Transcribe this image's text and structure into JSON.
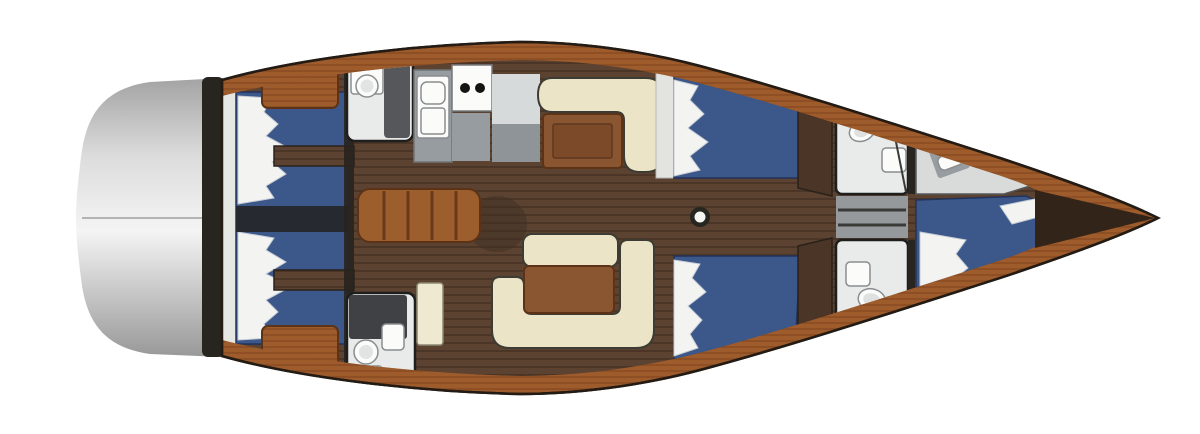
{
  "plan": {
    "type": "yacht-interior-floorplan",
    "orientation": "bow-right"
  },
  "colors": {
    "background": "#ffffff",
    "deck_wood": "#9e5b2b",
    "deck_wood_dark": "#83481f",
    "teak_floor": "#5b4231",
    "teak_stripe": "#48332400",
    "teak_stripe_solid": "#483324",
    "transom_dark": "#a3a3a3",
    "transom_mid": "#dcdcdc",
    "transom_light": "#f4f4f4",
    "transom_low": "#989898",
    "bulkhead_dark": "#28241f",
    "berth_blue": "#3c5789",
    "berth_blue_dark": "#2c4068",
    "pillow_white": "#f3f4f1",
    "pillow_shadow": "#c7cdd6",
    "settee_cream": "#ece4c6",
    "table_wood": "#8a5531",
    "table_panel": "#7c4a28",
    "steps_wood": "#9c5e2d",
    "head_floor": "#e9ebea",
    "head_gray": "#55575a",
    "head_counter_dark": "#3f4144",
    "counter_gray": "#979ca0",
    "counter_light": "#d6dadb",
    "fixture_white": "#fbfbfa",
    "burner_black": "#141412",
    "mast_ring": "#26251f",
    "wardrobe_wood": "#4a3526",
    "cabinet_cream": "#efe9d2",
    "headboard_white": "#e6e6e2",
    "centerline_dark": "#262a30",
    "bow_dark": "#322418",
    "shadow_brown": "#3f2f22",
    "passage_gray": "#96999b",
    "forepeak_gray": "#d9dbda"
  },
  "icons": {
    "mast-icon": "circle",
    "toilet-icon": "oval-bowl",
    "sink-icon": "rounded-rect-basin",
    "stove-burner-icon": "two-black-dots",
    "companionway-steps-icon": "slatted-rect"
  }
}
